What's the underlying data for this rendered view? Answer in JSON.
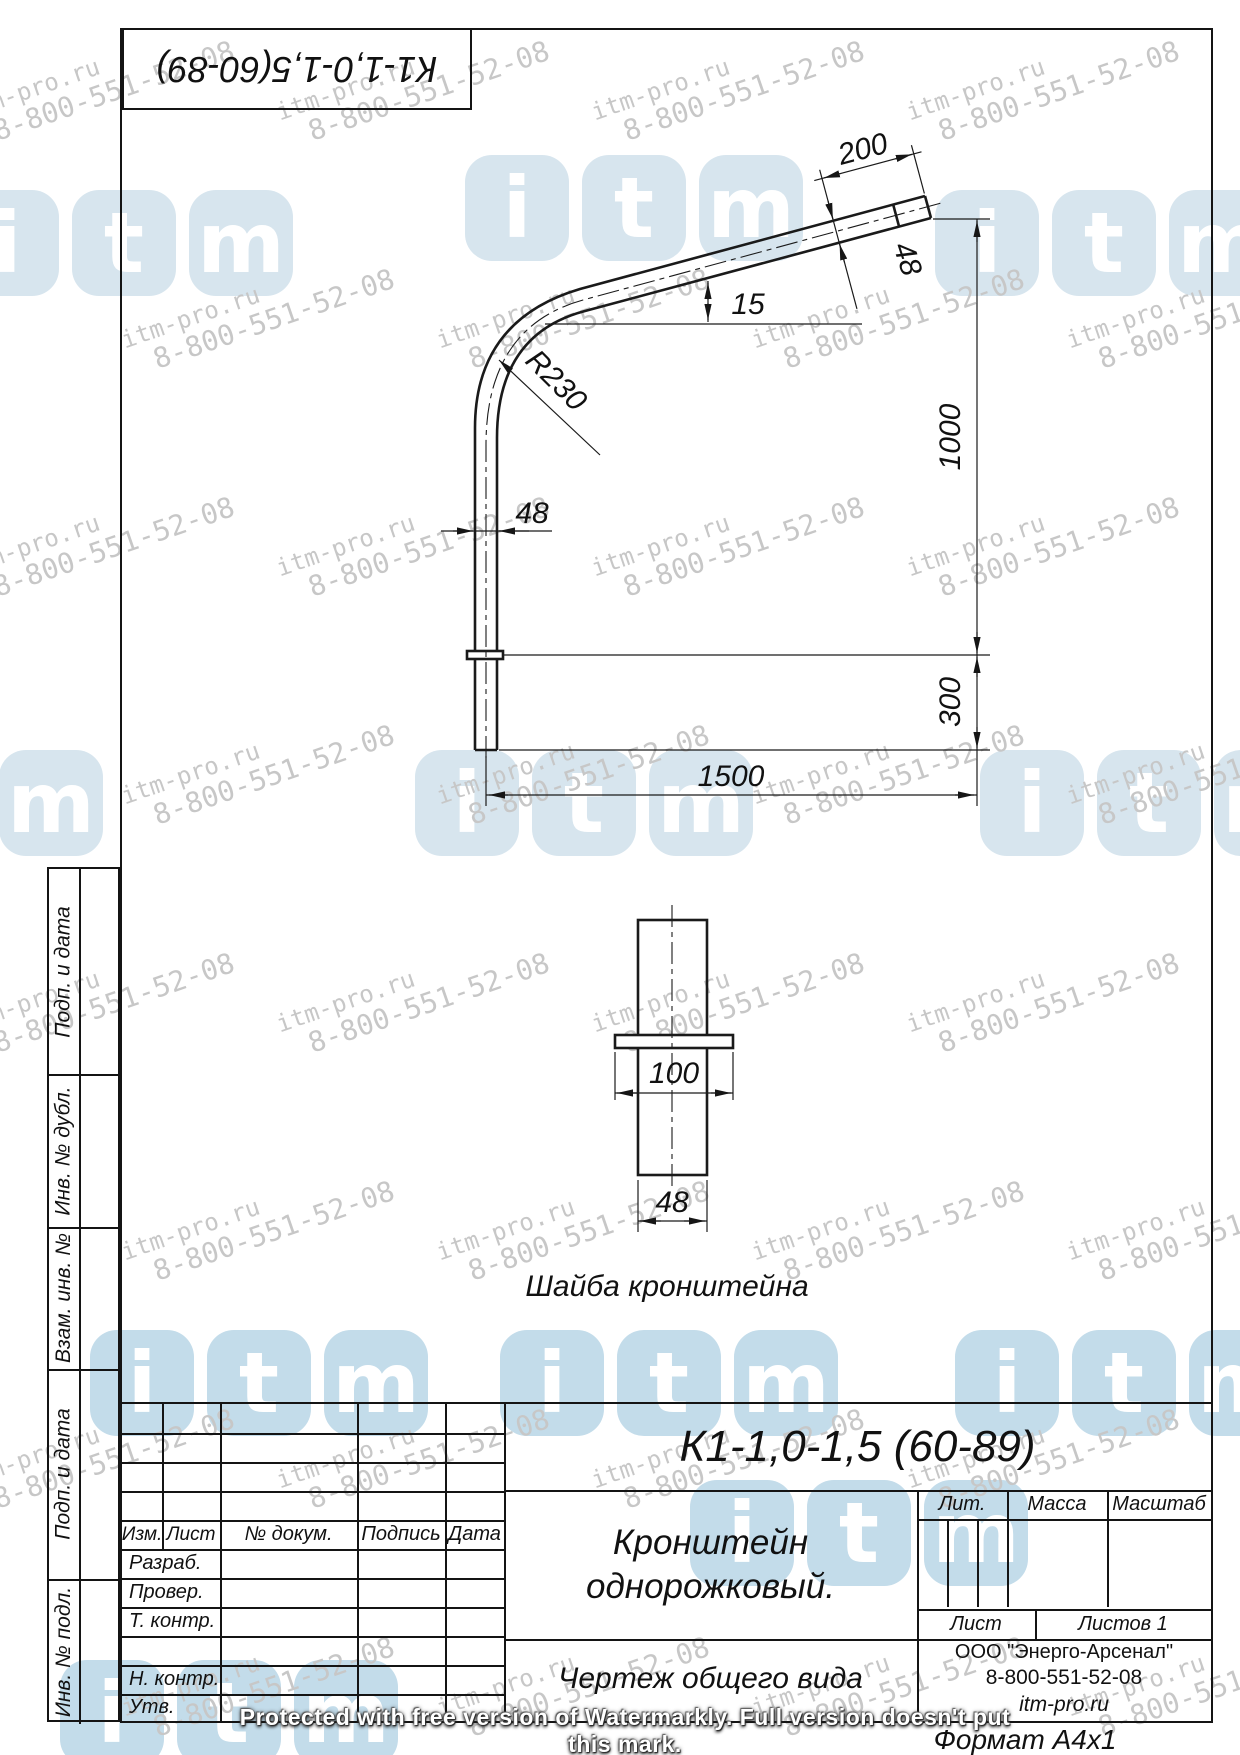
{
  "page": {
    "format_label": "Формат  А4х1"
  },
  "corner_stamp": {
    "designation": "К1-1,0-1,5(60-89)"
  },
  "side_strip": {
    "labels": [
      "Подп. и дата",
      "Инв. № дубл.",
      "Взам. инв. №",
      "Подп. и дата",
      "Инв. № подл."
    ]
  },
  "drawing": {
    "dims": {
      "arm_len": "200",
      "arm_dia": "48",
      "angle": "15",
      "radius": "R230",
      "mast_dia": "48",
      "height": "1000",
      "bottom": "300",
      "reach": "1500",
      "washer_width": "100",
      "washer_dia": "48"
    },
    "washer_caption": "Шайба кронштейна"
  },
  "title_block": {
    "designation": "К1-1,0-1,5 (60-89)",
    "name_line1": "Кронштейн",
    "name_line2": "однорожковый.",
    "doc_type": "Чертеж общего вида",
    "cols": {
      "izm": "Изм.",
      "list": "Лист",
      "doc": "№ докум.",
      "sign": "Подпись",
      "date": "Дата"
    },
    "rows": {
      "razrab": "Разраб.",
      "prover": "Провер.",
      "tkontr": "Т. контр.",
      "nkontr": "Н. контр.",
      "utv": "Утв."
    },
    "lit": "Лит.",
    "mass": "Масса",
    "scale": "Масштаб",
    "sheet": "Лист",
    "sheets": "Листов 1",
    "company": "ООО \"Энерго-Арсенал\"",
    "phone": "8-800-551-52-08",
    "site": "itm-pro.ru"
  },
  "watermark": {
    "site": "itm-pro.ru",
    "phone": "8-800-551-52-08",
    "protected_note": "Protected with free version of Watermarkly. Full version doesn't put this mark.",
    "logo_letters": "itm",
    "logo_color_light": "#d7e5ee",
    "logo_color_mid": "#c3dcea",
    "text_color": "#c7c7c7"
  }
}
